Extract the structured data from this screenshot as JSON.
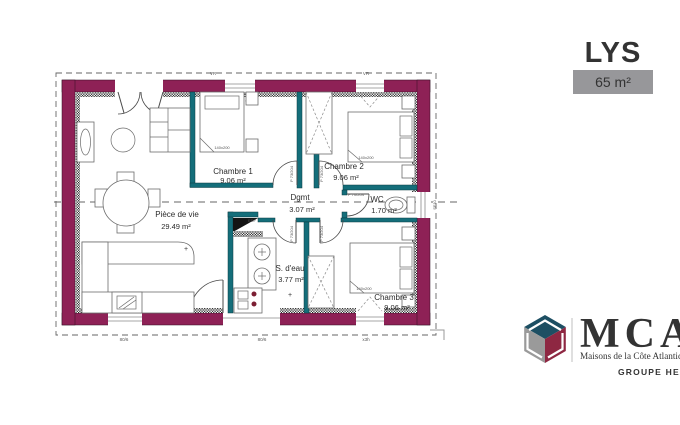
{
  "header": {
    "title": "LYS",
    "area_badge": "65 m²"
  },
  "plan": {
    "rooms": [
      {
        "name": "Chambre 1",
        "area": "9.06 m²"
      },
      {
        "name": "Chambre 2",
        "area": "9.06 m²"
      },
      {
        "name": "Chambre 3",
        "area": "9.06 m²"
      },
      {
        "name": "Pièce de vie",
        "area": "29.49 m²"
      },
      {
        "name": "Dgmt",
        "area": "3.07 m²"
      },
      {
        "name": "WC",
        "area": "1.70 m²"
      },
      {
        "name": "S. d'eau",
        "area": "3.77 m²"
      }
    ],
    "annotations": {
      "edf": "EDF",
      "bed_size": "140x200",
      "door_label": "P 73/204",
      "wc_door_label": "P 70/204",
      "window_label_right": "SF10",
      "shutter_label": "VR",
      "dim_bottom_1": "80/6",
      "dim_bottom_2": "80/6",
      "dim_bottom_3": "x3h",
      "plus_mark": "+"
    },
    "colors": {
      "exterior_wall": "#8e2156",
      "interior_wall": "#146e7a",
      "section_line": "#666666"
    }
  },
  "logo": {
    "brand": "MCA",
    "tagline": "Maisons de la Côte Atlantique",
    "group": "GROUPE HEXAOM",
    "navy": "#1d4f63",
    "maroon": "#8e2742",
    "gray": "#9a9a9a"
  }
}
